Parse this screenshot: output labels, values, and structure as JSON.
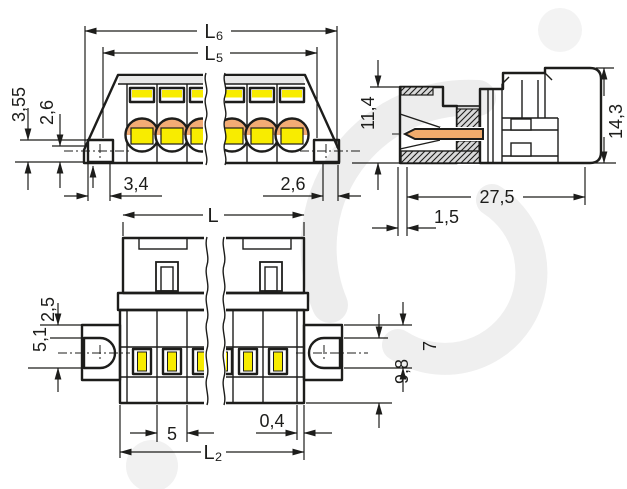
{
  "drawing": {
    "type": "technical-dimension-drawing",
    "subject": "multi-pole pluggable terminal block connector, 3 orthographic views with break lines",
    "colors": {
      "line": "#1d1d1b",
      "body_gray": "#d9d9d9",
      "body_light": "#e6e6e6",
      "yellow": "#f8ec00",
      "orange": "#f0ab6c",
      "watermark": "#ededed",
      "background": "#ffffff"
    }
  },
  "views": {
    "front": {
      "name": "front view",
      "l6": "L₆",
      "l5": "L₅",
      "h_total": "3,55",
      "h_partial": "2,6",
      "w_left": "3,4",
      "w_right": "2,6"
    },
    "side": {
      "name": "side section view",
      "h_front": "11,4",
      "h_total": "14,3",
      "depth": "27,5",
      "pin_offset": "1,5"
    },
    "top": {
      "name": "top view",
      "l": "L",
      "ear_top": "2,5",
      "hole_height": "5,1",
      "ear_right_a": "7",
      "ear_right_b": "9,8",
      "pitch": "5",
      "end_wall": "0,4",
      "l2": "L₂"
    }
  }
}
